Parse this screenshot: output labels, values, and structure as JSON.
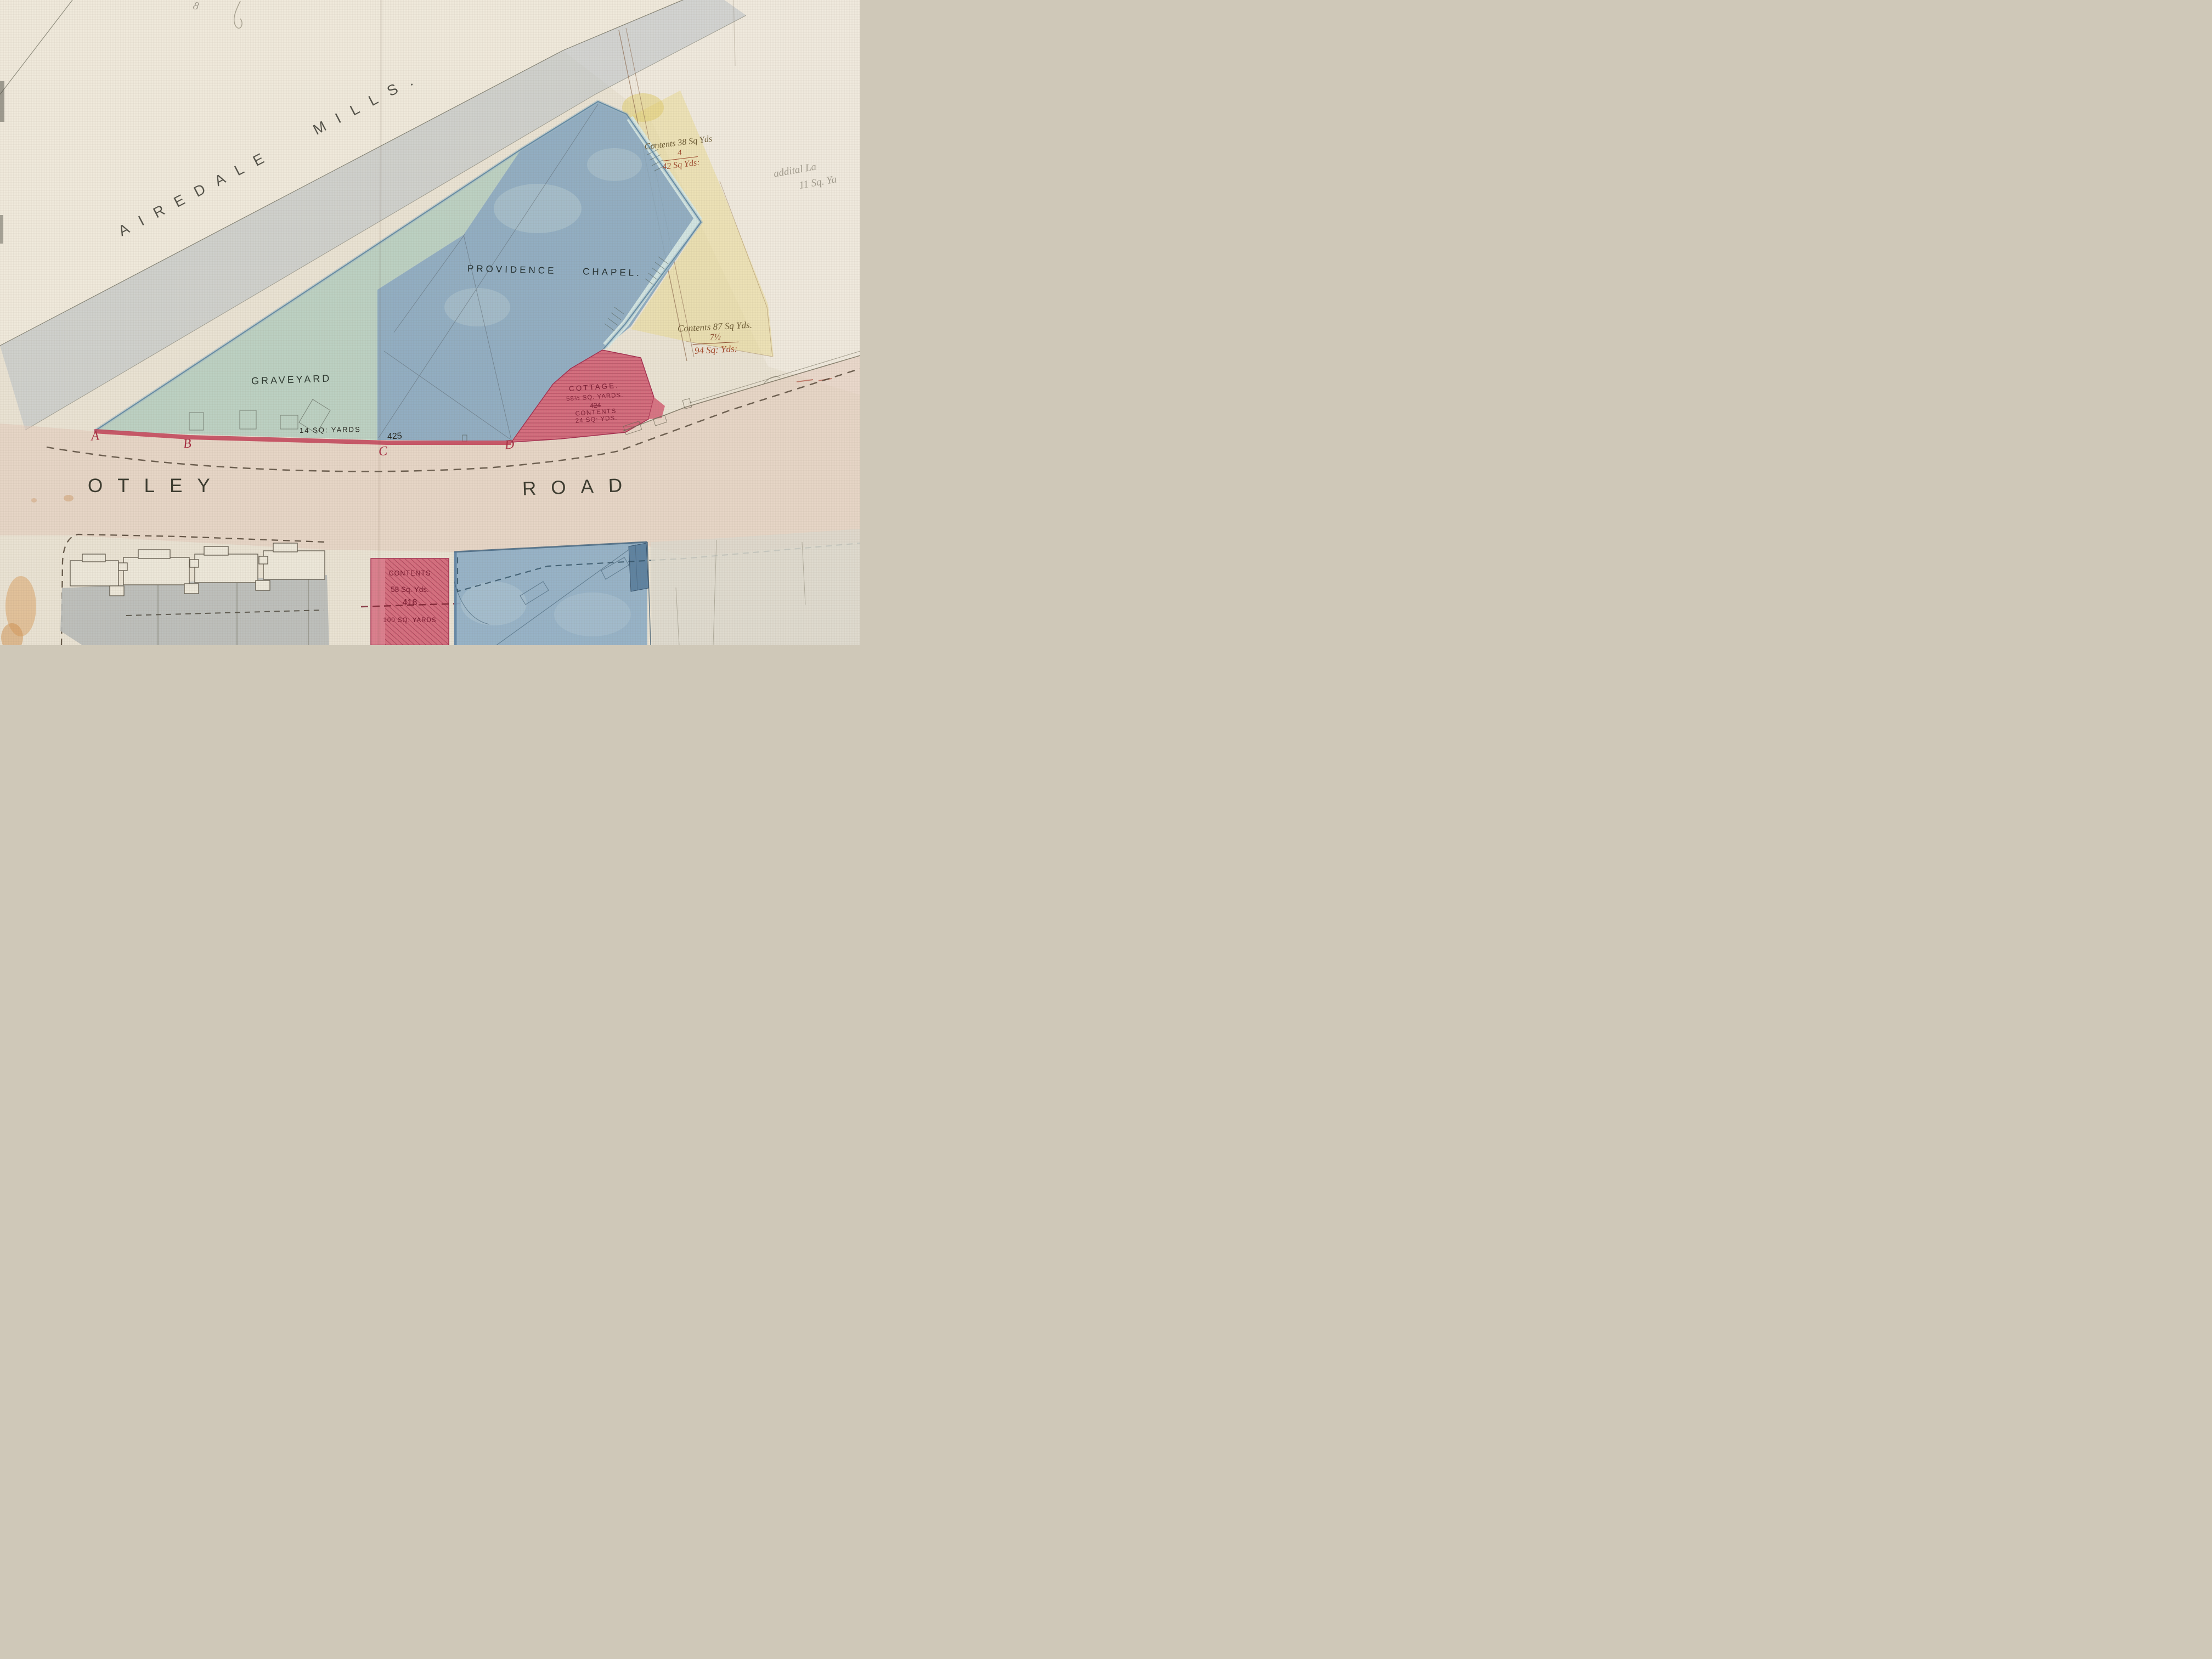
{
  "map": {
    "title": "Hand-drawn land plan – Providence Chapel, Otley Road",
    "areas": {
      "mills_label": "AIREDALE MILLS.",
      "chapel_label": "PROVIDENCE CHAPEL.",
      "graveyard_label": "GRAVEYARD",
      "road_label_west": "OTLEY",
      "road_label_east": "ROAD"
    },
    "parcels": {
      "graveyard_strip": {
        "area": "14 SQ: YARDS",
        "number": "425"
      },
      "cottage": {
        "name": "COTTAGE.",
        "area": "58½ SQ. YARDS.",
        "number": "424",
        "contents_label": "CONTENTS",
        "contents_value": "24 SQ: YDS."
      },
      "parcel_418": {
        "contents_label": "CONTENTS",
        "contents_value": "58 Sq. Yds.",
        "number": "418",
        "area": "100 SQ: YARDS"
      },
      "north_east": {
        "line1": "Contents 38 Sq Yds",
        "addition": "4",
        "total": "42 Sq Yds:"
      },
      "east": {
        "line1": "Contents 87 Sq Yds.",
        "addition": "7½",
        "total": "94 Sq: Yds:"
      }
    },
    "annotations": {
      "pencil_note_line1": "addital La",
      "pencil_note_line2": "11 Sq. Ya",
      "pencil_mark_top": "8"
    },
    "reference_points": [
      "A",
      "B",
      "C",
      "D"
    ],
    "colors": {
      "linen_background": "#e9e2d3",
      "graveyard_green": "#b5cdbf",
      "chapel_blue": "#88a8c0",
      "parcel_red": "#d4687a",
      "parcel_yellow": "#e9da90",
      "road_wash": "#e3cbbb",
      "shadow_grey": "#b6bec6",
      "red_ink": "#a63244",
      "brown_ink": "#8a5a38"
    }
  }
}
